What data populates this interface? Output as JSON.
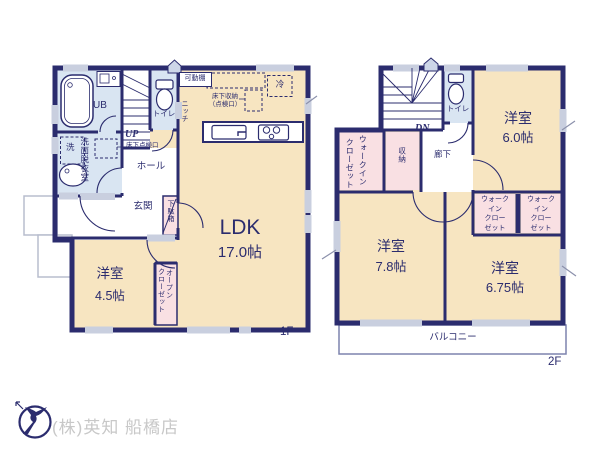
{
  "colors": {
    "wall_navy": "#2b2c6e",
    "room_cream": "#f7e5c1",
    "wet_area_blue": "#d9e5f2",
    "closet_pink": "#f9e0e3",
    "fixture_gray": "#c9cfdf",
    "logo_text_gray": "#c8c8c8"
  },
  "floor1": {
    "floor_label": "1F",
    "labels": {
      "ub": "UB",
      "toilet": "トイレ",
      "hall": "ホール",
      "entrance": "玄関",
      "ldk_name": "LDK",
      "ldk_size": "17.0帖",
      "bedroom_name": "洋室",
      "bedroom_size": "4.5帖",
      "washroom_vertical": "洗面脱衣室",
      "washer": "洗",
      "movable_shelf": "可動棚",
      "fridge": "冷",
      "underfloor_storage_line1": "床下収納",
      "underfloor_storage_line2": "（点検口）",
      "niche": "ニッチ",
      "up": "UP",
      "underfloor_access": "床下点検口",
      "shoe_box": "下駄箱",
      "open_closet_col1": "オープン",
      "open_closet_col2": "クローゼット"
    }
  },
  "floor2": {
    "floor_label": "2F",
    "labels": {
      "dn": "DN",
      "toilet": "トイレ",
      "corridor": "廊下",
      "storage": "収納",
      "wic_left_col1": "ウォークイン",
      "wic_left_col2": "クローゼット",
      "room6_name": "洋室",
      "room6_size": "6.0帖",
      "room78_name": "洋室",
      "room78_size": "7.8帖",
      "room675_name": "洋室",
      "room675_size": "6.75帖",
      "wic_line1": "ウォーク",
      "wic_line2": "イン",
      "wic_line3": "クロー",
      "wic_line4": "ゼット",
      "balcony": "バルコニー"
    }
  },
  "logo": {
    "company_name": "(株)英知 船橋店"
  }
}
